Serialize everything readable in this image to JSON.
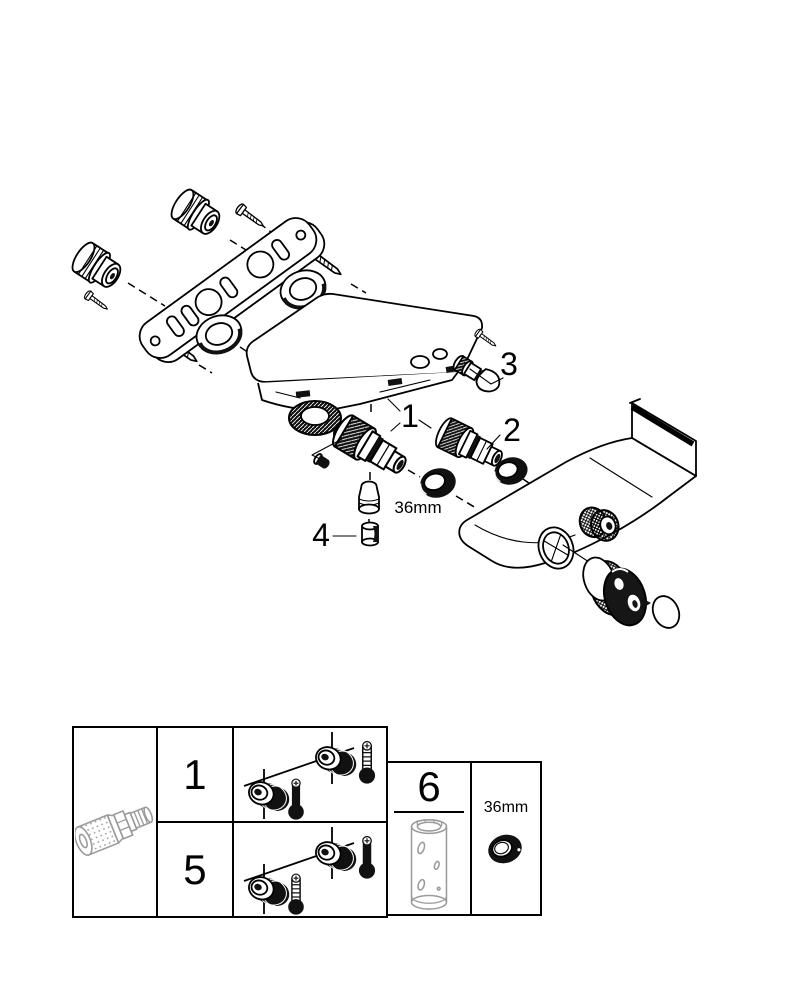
{
  "page": {
    "background": "#ffffff",
    "ink": "#000000",
    "part_gray": "#9b9b9b"
  },
  "exploded_view": {
    "callouts": {
      "c1": "1",
      "c2": "2",
      "c3": "3",
      "c4": "4"
    },
    "ring_size_label": "36mm"
  },
  "legend": {
    "variant_rows": [
      {
        "label": "1"
      },
      {
        "label": "5"
      }
    ],
    "tool_label": "6",
    "ring_size_label": "36mm"
  }
}
